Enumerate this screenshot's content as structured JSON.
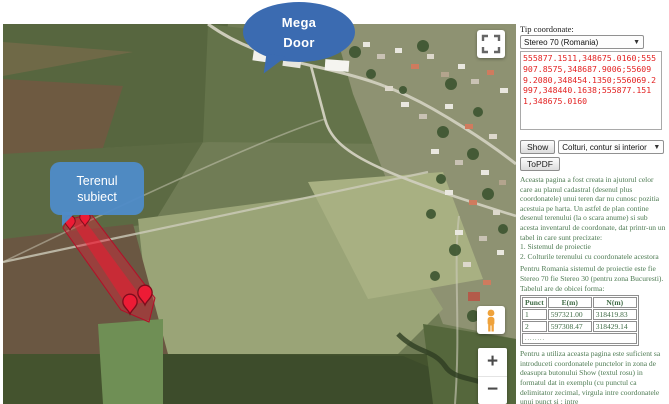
{
  "map": {
    "mega_door_callout": {
      "line1": "Mega",
      "line2": "Door"
    },
    "terenul_callout": {
      "line1": "Terenul",
      "line2": "subiect"
    },
    "controls": {
      "zoom_in": "+",
      "zoom_out": "−",
      "fullscreen_icon": "fullscreen-icon",
      "pegman_icon": "pegman-icon"
    },
    "markers": {
      "count": 4,
      "icon": "map-pin-icon"
    }
  },
  "panel": {
    "coord_type_label": "Tip coordonate:",
    "coord_system_value": "Stereo 70 (Romania)",
    "coordinates_value": "555877.1511,348675.0160;555907.8575,348687.9006;556099.2080,348454.1350;556069.2997,348440.1638;555877.1511,348675.0160",
    "show_button": "Show",
    "display_mode_value": "Colturi, contur si interior",
    "topdf_button": "ToPDF",
    "intro_text": "Aceasta pagina a fost creata in ajutorul celor care au planul cadastral (desenul plus coordonatele) unui teren dar nu cunosc pozitia acestuia pe harta. Un astfel de plan contine desenul terenului (la o scara anume) si sub acesta inventarul de coordonate, dat printr-un un tabel in care sunt precizate:",
    "list_item_1": "1. Sistemul de proiectie",
    "list_item_2": "2. Colturile terenului cu coordonatele acestora",
    "projection_text": "Pentru Romania sistemul de proiectie este fie Stereo 70 fie Stereo 30 (pentru zona Bucuresti). Tabelul are de obicei forma:",
    "table": {
      "headers": [
        "Punct",
        "E(m)",
        "N(m)"
      ],
      "rows": [
        [
          "1",
          "597321.00",
          "318419.83"
        ],
        [
          "2",
          "597308.47",
          "318429.14"
        ]
      ],
      "more_row": "........"
    },
    "usage_text": "Pentru a utiliza aceasta pagina este suficient sa introduceti coordonatele punctelor in zona de deasupra butonului Show (textul rosu) in formatul dat in exemplu (cu punctul ca delimitator zecimal, virgula intre coordonatele unui punct si ; intre"
  },
  "colors": {
    "callout_blue_dark": "#3b6bb1",
    "callout_blue_light": "#4f8bc8",
    "coordinates_text": "#e32222",
    "panel_text_green": "#4d7a52",
    "parcel_red": "#e21e37",
    "pin_red": "#ed1b35"
  }
}
